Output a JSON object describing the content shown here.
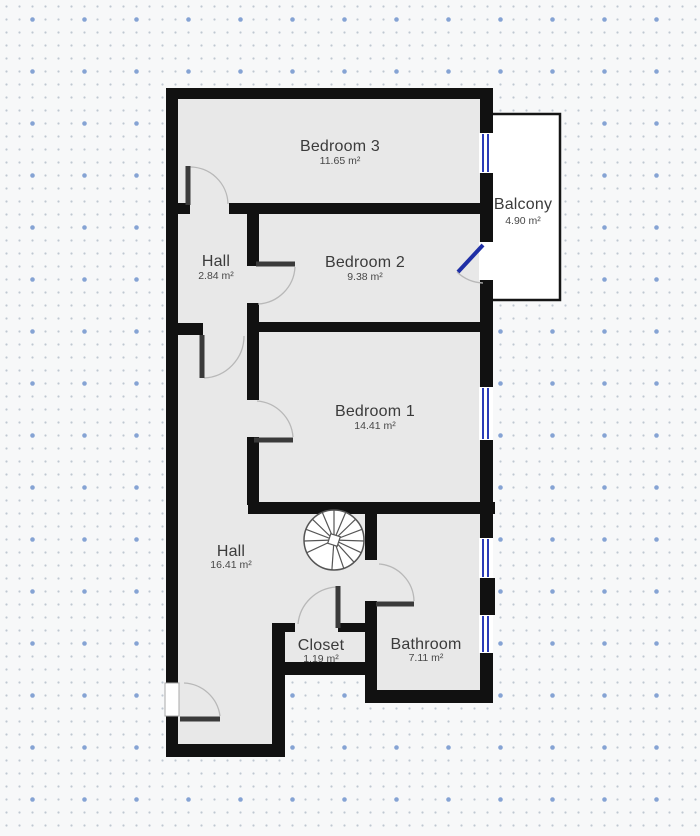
{
  "plan": {
    "rooms": {
      "bedroom3": {
        "name": "Bedroom 3",
        "area": "11.65 m²"
      },
      "balcony": {
        "name": "Balcony",
        "area": "4.90 m²"
      },
      "hall_upper": {
        "name": "Hall",
        "area": "2.84 m²"
      },
      "bedroom2": {
        "name": "Bedroom 2",
        "area": "9.38 m²"
      },
      "bedroom1": {
        "name": "Bedroom 1",
        "area": "14.41 m²"
      },
      "hall_lower": {
        "name": "Hall",
        "area": "16.41 m²"
      },
      "closet": {
        "name": "Closet",
        "area": "1.19 m²"
      },
      "bathroom": {
        "name": "Bathroom",
        "area": "7.11 m²"
      }
    }
  },
  "colors": {
    "wall": "#111111",
    "room_fill": "#e8e8e8",
    "background": "#f7f8f9",
    "dot_small": "#bfc7d1",
    "dot_large": "#85a3d4",
    "window": "#2b3cb8",
    "glass_door": "#1f2fa6",
    "door_leaf": "#3a3a3a",
    "swing_arc": "#b8b8b8",
    "balcony_fill": "#ffffff"
  }
}
